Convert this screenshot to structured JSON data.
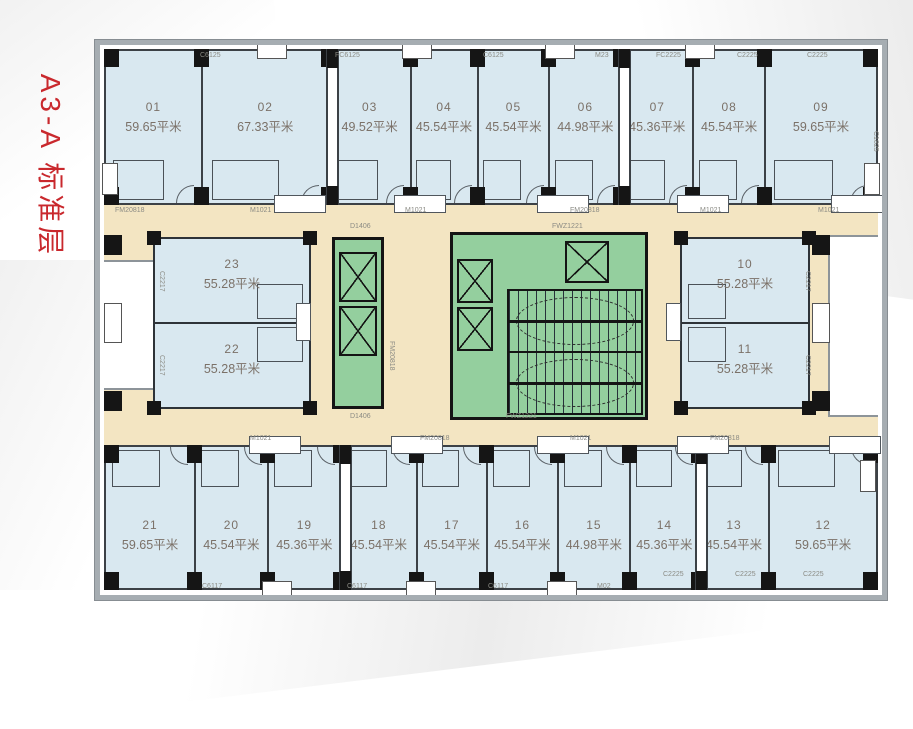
{
  "title": {
    "text": "A3-A 标准层"
  },
  "rooms": {
    "top": [
      {
        "no": "01",
        "area": "59.65平米"
      },
      {
        "no": "02",
        "area": "67.33平米"
      },
      {
        "no": "03",
        "area": "49.52平米"
      },
      {
        "no": "04",
        "area": "45.54平米"
      },
      {
        "no": "05",
        "area": "45.54平米"
      },
      {
        "no": "06",
        "area": "44.98平米"
      },
      {
        "no": "07",
        "area": "45.36平米"
      },
      {
        "no": "08",
        "area": "45.54平米"
      },
      {
        "no": "09",
        "area": "59.65平米"
      }
    ],
    "middle_left": [
      {
        "no": "23",
        "area": "55.28平米"
      },
      {
        "no": "22",
        "area": "55.28平米"
      }
    ],
    "middle_right": [
      {
        "no": "10",
        "area": "55.28平米"
      },
      {
        "no": "11",
        "area": "55.28平米"
      }
    ],
    "bottom": [
      {
        "no": "21",
        "area": "59.65平米"
      },
      {
        "no": "20",
        "area": "45.54平米"
      },
      {
        "no": "19",
        "area": "45.36平米"
      },
      {
        "no": "18",
        "area": "45.54平米"
      },
      {
        "no": "17",
        "area": "45.54平米"
      },
      {
        "no": "16",
        "area": "45.54平米"
      },
      {
        "no": "15",
        "area": "44.98平米"
      },
      {
        "no": "14",
        "area": "45.36平米"
      },
      {
        "no": "13",
        "area": "45.54平米"
      },
      {
        "no": "12",
        "area": "59.65平米"
      }
    ]
  },
  "codes": {
    "c6125": "C6125",
    "fc6125": "FC6125",
    "m23": "M23",
    "fc2225": "FC2225",
    "c2225": "C2225",
    "c6117": "C6117",
    "m02": "M02",
    "c2217": "C2217",
    "c1825": "C1825",
    "d1406": "D1406",
    "fwz1221": "FWZ1221",
    "fm20818": "FM20818",
    "m1021": "M1021"
  },
  "colors": {
    "title_red": "#c9282d",
    "room_fill": "#d9e8f0",
    "corridor_fill": "#f3e5c2",
    "core_fill": "#94cf9e",
    "wall": "#3c4146",
    "outer_wall": "#a6adb2",
    "room_text": "#7b7168",
    "code_text": "#8b8b84"
  }
}
